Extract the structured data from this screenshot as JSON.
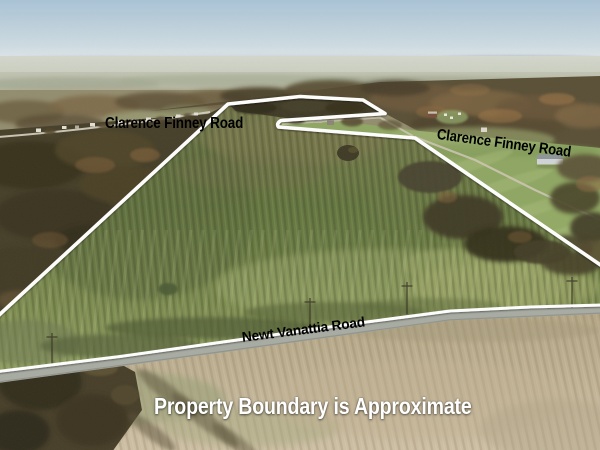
{
  "labels": {
    "road_west": "Clarence Finney Road",
    "road_east": "Clarence Finney Road",
    "road_south": "Newt Vanattia Road",
    "disclaimer": "Property Boundary is Approximate"
  },
  "colors": {
    "boundary_line": "#ffffff",
    "road_edge_line": "#ffffff",
    "road_label_text": "#000000",
    "disclaimer_text": "#ffffff",
    "sky_top": "#a9c2d4",
    "field_green": "#6d7c49",
    "pasture_green": "#8fa763",
    "harvested_field_tan": "#bcae8e",
    "asphalt_gray": "#a8aca3",
    "autumn_woods_brown": "#5a5038"
  }
}
